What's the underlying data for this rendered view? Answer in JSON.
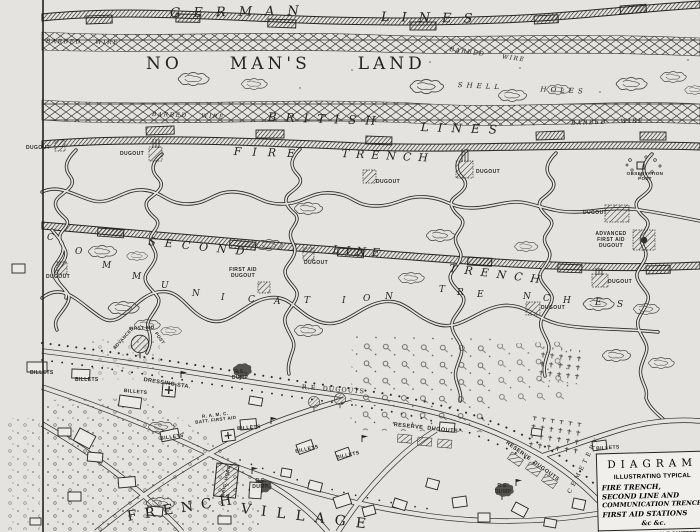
{
  "colors": {
    "paper": "#e5e3df",
    "ink": "#26241f"
  },
  "legend": {
    "l1": "DIAGRAM",
    "l2": "ILLUSTRATING TYPICAL",
    "l3": "FIRE TRENCH,",
    "l4": "SECOND LINE AND",
    "l5": "COMMUNICATION TRENCHES",
    "l6": "FIRST AID STATIONS",
    "l7": "&c  &c.",
    "footnote": "CONTOURS & SCALE OMITTED"
  },
  "map": {
    "labels": [
      {
        "n": "german-lines-label-1",
        "t": "GERMAN",
        "x": 170,
        "y": 7,
        "fs": 13,
        "ls": 13,
        "rot": -1,
        "cls": "hand"
      },
      {
        "n": "german-lines-label-2",
        "t": "LINES",
        "x": 381,
        "y": 11,
        "fs": 13,
        "ls": 12,
        "rot": 1,
        "cls": "hand"
      },
      {
        "n": "barbed-wire-label-1",
        "t": "BARBED    WIRE",
        "x": 46,
        "y": 39,
        "fs": 6,
        "ls": 1.5,
        "rot": 1,
        "cls": "hand"
      },
      {
        "n": "no-mans-land-label",
        "t": "NO     MAN'S     LAND",
        "x": 146,
        "y": 55,
        "fs": 17,
        "ls": 4,
        "cls": "serif"
      },
      {
        "n": "barbed-wire-label-2",
        "t": "BARBED     WIRE",
        "x": 450,
        "y": 47,
        "fs": 6,
        "ls": 1.5,
        "rot": 8,
        "cls": "hand"
      },
      {
        "n": "shell-holes-label",
        "t": "SHELL      HOLES",
        "x": 458,
        "y": 81,
        "fs": 7,
        "ls": 4,
        "rot": 3,
        "cls": "hand"
      },
      {
        "n": "barbed-wire-label-3",
        "t": "BARBED    WIRE",
        "x": 152,
        "y": 112,
        "fs": 6,
        "ls": 1.5,
        "rot": 2,
        "cls": "hand"
      },
      {
        "n": "british-lines-label-1",
        "t": "BRITISH",
        "x": 268,
        "y": 111,
        "fs": 12,
        "ls": 9,
        "rot": 2,
        "cls": "hand"
      },
      {
        "n": "british-lines-label-2",
        "t": "LINES",
        "x": 421,
        "y": 121,
        "fs": 12,
        "ls": 9,
        "rot": 2,
        "cls": "hand"
      },
      {
        "n": "barbed-wire-label-4",
        "t": "BARBED    WIRE",
        "x": 571,
        "y": 121,
        "fs": 6,
        "ls": 1.5,
        "rot": -2,
        "cls": "hand"
      },
      {
        "n": "fire-trench-label-1",
        "t": "FIRE",
        "x": 234,
        "y": 146,
        "fs": 11,
        "ls": 11,
        "rot": 2,
        "cls": "hand"
      },
      {
        "n": "fire-trench-label-2",
        "t": "TRENCH",
        "x": 342,
        "y": 148,
        "fs": 11,
        "ls": 7,
        "rot": 3,
        "cls": "hand"
      },
      {
        "n": "dugout-label-1",
        "t": "DUGOUT",
        "x": 26,
        "y": 146,
        "fs": 5,
        "cls": "tiny"
      },
      {
        "n": "dugout-label-2",
        "t": "DUGOUT",
        "x": 120,
        "y": 152,
        "fs": 5,
        "cls": "tiny"
      },
      {
        "n": "dugout-label-3",
        "t": "DUGOUT",
        "x": 376,
        "y": 180,
        "fs": 5,
        "cls": "tiny"
      },
      {
        "n": "dugout-label-4",
        "t": "DUGOUT",
        "x": 476,
        "y": 170,
        "fs": 5,
        "cls": "tiny"
      },
      {
        "n": "observation-post-label",
        "t": "OBSERVATION\nPOST",
        "x": 625,
        "y": 171,
        "fs": 4.5,
        "cls": "tiny",
        "ctr": 1,
        "w": 40
      },
      {
        "n": "dugout-label-5",
        "t": "DUGOUT",
        "x": 583,
        "y": 211,
        "fs": 5,
        "cls": "tiny"
      },
      {
        "n": "advanced-first-aid-dugout-label",
        "t": "ADVANCED\nFIRST AID\nDUGOUT",
        "x": 592,
        "y": 232,
        "fs": 5,
        "cls": "tiny",
        "ctr": 1,
        "w": 38
      },
      {
        "n": "second-line-label-1",
        "t": "SECOND",
        "x": 149,
        "y": 236,
        "fs": 11,
        "ls": 9,
        "rot": 6,
        "cls": "hand"
      },
      {
        "n": "second-line-label-2",
        "t": "LINE",
        "x": 333,
        "y": 244,
        "fs": 11,
        "ls": 6,
        "rot": 4,
        "cls": "hand"
      },
      {
        "n": "second-line-label-3",
        "t": "TRENCH",
        "x": 450,
        "y": 263,
        "fs": 11,
        "ls": 8,
        "rot": 7,
        "cls": "hand"
      },
      {
        "n": "dugout-label-6",
        "t": "DUGOUT",
        "x": 304,
        "y": 261,
        "fs": 5,
        "cls": "tiny"
      },
      {
        "n": "dugout-label-7",
        "t": "DUGOUT",
        "x": 46,
        "y": 275,
        "fs": 5,
        "cls": "tiny"
      },
      {
        "n": "first-aid-dugout-label",
        "t": "FIRST AID\nDUGOUT",
        "x": 226,
        "y": 268,
        "fs": 5,
        "cls": "tiny",
        "ctr": 1,
        "w": 34
      },
      {
        "n": "dugout-label-8",
        "t": "DUGOUT",
        "x": 608,
        "y": 280,
        "fs": 5,
        "cls": "tiny"
      },
      {
        "n": "dugout-label-9",
        "t": "DUGOUT",
        "x": 541,
        "y": 306,
        "fs": 5,
        "cls": "tiny"
      },
      {
        "n": "comm-letter-1",
        "t": "C",
        "x": 47,
        "y": 233,
        "fs": 9,
        "cls": "hand"
      },
      {
        "n": "comm-letter-2",
        "t": "O",
        "x": 75,
        "y": 247,
        "fs": 9,
        "cls": "hand"
      },
      {
        "n": "comm-letter-3",
        "t": "M",
        "x": 102,
        "y": 261,
        "fs": 9,
        "cls": "hand"
      },
      {
        "n": "comm-letter-4",
        "t": "M",
        "x": 132,
        "y": 272,
        "fs": 9,
        "cls": "hand"
      },
      {
        "n": "comm-letter-5",
        "t": "U",
        "x": 161,
        "y": 281,
        "fs": 9,
        "cls": "hand"
      },
      {
        "n": "comm-letter-6",
        "t": "N",
        "x": 192,
        "y": 289,
        "fs": 9,
        "cls": "hand"
      },
      {
        "n": "comm-letter-7",
        "t": "I",
        "x": 221,
        "y": 293,
        "fs": 9,
        "cls": "hand"
      },
      {
        "n": "comm-letter-8",
        "t": "C",
        "x": 248,
        "y": 295,
        "fs": 9,
        "cls": "hand"
      },
      {
        "n": "comm-letter-9",
        "t": "A",
        "x": 274,
        "y": 297,
        "fs": 9,
        "cls": "hand"
      },
      {
        "n": "comm-letter-10",
        "t": "T",
        "x": 304,
        "y": 296,
        "fs": 9,
        "cls": "hand"
      },
      {
        "n": "comm-letter-11",
        "t": "I",
        "x": 342,
        "y": 296,
        "fs": 9,
        "cls": "hand"
      },
      {
        "n": "comm-letter-12",
        "t": "O",
        "x": 363,
        "y": 294,
        "fs": 9,
        "cls": "hand"
      },
      {
        "n": "comm-letter-13",
        "t": "N",
        "x": 385,
        "y": 292,
        "fs": 9,
        "cls": "hand"
      },
      {
        "n": "trenches-letter-1",
        "t": "T",
        "x": 439,
        "y": 285,
        "fs": 9,
        "cls": "hand"
      },
      {
        "n": "trenches-letter-2",
        "t": "R",
        "x": 457,
        "y": 288,
        "fs": 9,
        "cls": "hand"
      },
      {
        "n": "trenches-letter-3",
        "t": "E",
        "x": 477,
        "y": 290,
        "fs": 9,
        "cls": "hand"
      },
      {
        "n": "trenches-letter-4",
        "t": "N",
        "x": 523,
        "y": 292,
        "fs": 9,
        "cls": "hand"
      },
      {
        "n": "trenches-letter-5",
        "t": "C",
        "x": 543,
        "y": 294,
        "fs": 9,
        "cls": "hand"
      },
      {
        "n": "trenches-letter-6",
        "t": "H",
        "x": 563,
        "y": 296,
        "fs": 9,
        "cls": "hand"
      },
      {
        "n": "trenches-letter-7",
        "t": "E",
        "x": 595,
        "y": 298,
        "fs": 9,
        "cls": "hand"
      },
      {
        "n": "trenches-letter-8",
        "t": "S",
        "x": 617,
        "y": 300,
        "fs": 9,
        "cls": "hand"
      },
      {
        "n": "advanced-first-aid-post-label-1",
        "t": "ADVANCED",
        "x": 112,
        "y": 347,
        "fs": 4.5,
        "rot": -48,
        "cls": "tiny"
      },
      {
        "n": "advanced-first-aid-post-label-2",
        "t": "FIRST AID",
        "x": 129,
        "y": 326,
        "fs": 4.5,
        "rot": -3,
        "cls": "tiny"
      },
      {
        "n": "advanced-first-aid-post-label-3",
        "t": "POST",
        "x": 158,
        "y": 331,
        "fs": 4.5,
        "rot": 55,
        "cls": "tiny"
      },
      {
        "n": "billets-label-1",
        "t": "BILLETS",
        "x": 30,
        "y": 371,
        "fs": 5,
        "cls": "tiny"
      },
      {
        "n": "billets-label-2",
        "t": "BILLETS",
        "x": 75,
        "y": 378,
        "fs": 5,
        "cls": "tiny"
      },
      {
        "n": "billets-label-3",
        "t": "BILLETS",
        "x": 124,
        "y": 389,
        "fs": 5,
        "rot": 5,
        "cls": "tiny"
      },
      {
        "n": "dressing-station-label",
        "t": "DRESSING STA.",
        "x": 144,
        "y": 377,
        "fs": 5.5,
        "rot": 9,
        "cls": "tiny"
      },
      {
        "n": "re-dump-label-1",
        "t": "R.E.\nDUMP",
        "x": 228,
        "y": 370,
        "fs": 5,
        "cls": "tiny",
        "ctr": 1,
        "w": 24
      },
      {
        "n": "re-dugouts-label",
        "t": "R.E. DUGOUTS",
        "x": 302,
        "y": 384,
        "fs": 6.5,
        "ls": 1,
        "rot": 4,
        "cls": "serif"
      },
      {
        "n": "ramc-first-aid-label",
        "t": "R. A. M. C.\nBATT. FIRST AID",
        "x": 193,
        "y": 415,
        "fs": 4.5,
        "rot": -7,
        "cls": "tiny",
        "ctr": 1,
        "w": 44
      },
      {
        "n": "billets-label-4",
        "t": "BILLETS",
        "x": 237,
        "y": 427,
        "fs": 5,
        "rot": -5,
        "cls": "tiny"
      },
      {
        "n": "billets-label-5",
        "t": "BILLETS",
        "x": 160,
        "y": 437,
        "fs": 5,
        "rot": -8,
        "cls": "tiny"
      },
      {
        "n": "billets-label-6",
        "t": "BILLETS",
        "x": 295,
        "y": 450,
        "fs": 5,
        "rot": -12,
        "cls": "tiny"
      },
      {
        "n": "billets-label-7",
        "t": "BILLETS",
        "x": 336,
        "y": 456,
        "fs": 5,
        "rot": -12,
        "cls": "tiny"
      },
      {
        "n": "reserve-dugouts-label-1",
        "t": "RESERVE  DUGOUTS",
        "x": 394,
        "y": 422,
        "fs": 5.5,
        "ls": 0.5,
        "rot": 6,
        "cls": "tiny"
      },
      {
        "n": "reserve-dugouts-label-2",
        "t": "RESERVE  DUGOUTS",
        "x": 508,
        "y": 440,
        "fs": 5.5,
        "ls": 0.5,
        "rot": 36,
        "cls": "tiny"
      },
      {
        "n": "cemetery-label",
        "t": "CEMETERY",
        "x": 567,
        "y": 492,
        "fs": 6,
        "ls": 3.5,
        "rot": -63,
        "cls": "serif"
      },
      {
        "n": "brig-hqrs-label",
        "t": "BRIG. HQRS.",
        "x": 220,
        "y": 496,
        "fs": 4.5,
        "ls": 0.5,
        "rot": -78,
        "cls": "tiny"
      },
      {
        "n": "re-dump-label-2",
        "t": "R.E.\nDUMP.",
        "x": 249,
        "y": 479,
        "fs": 5,
        "cls": "tiny",
        "ctr": 1,
        "w": 24
      },
      {
        "n": "re-dump-label-3",
        "t": "R.E.\nDUMP",
        "x": 492,
        "y": 484,
        "fs": 5,
        "cls": "tiny",
        "ctr": 1,
        "w": 22
      },
      {
        "n": "french-village-label-1",
        "t": "FRENCH",
        "x": 126,
        "y": 509,
        "fs": 14,
        "ls": 8,
        "rot": -9,
        "cls": "serif"
      },
      {
        "n": "french-village-label-2",
        "t": "VILLAGE",
        "x": 242,
        "y": 501,
        "fs": 14,
        "ls": 10,
        "rot": 7,
        "cls": "serif"
      },
      {
        "n": "billets-label-8",
        "t": "BILLETS",
        "x": 596,
        "y": 447,
        "fs": 5,
        "rot": -4,
        "cls": "tiny"
      },
      {
        "n": "billets-label-9",
        "t": "BILLETS",
        "x": 634,
        "y": 455,
        "fs": 5,
        "rot": -4,
        "cls": "tiny"
      }
    ]
  }
}
